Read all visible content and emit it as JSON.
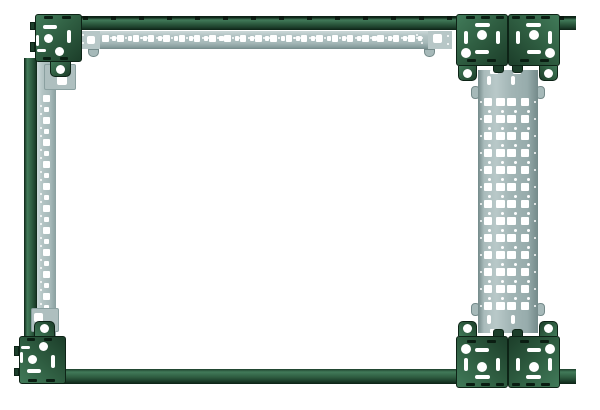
{
  "scene": {
    "background_color": "#ffffff",
    "subject": "Perforated steel rack frame: green corner brackets and frame rails with galvanized perforated mounting strips and one wide perforated mounting rail"
  },
  "palette": {
    "green": "#2e5c40",
    "green_light": "#417a59",
    "green_dark": "#1c3e2a",
    "green_edge": "#0d2316",
    "slot_dark": "#0a1d12",
    "gray": "#a6b9b9",
    "gray_light": "#ccd9d9",
    "gray_dark": "#8aa0a0",
    "gray_edge": "#748a8a",
    "gray_connector": "#b7c7c7",
    "hole_white": "#ffffff"
  },
  "components": {
    "top_rail": "green horizontal frame rail with perforated mounting strip",
    "bottom_rail": "green horizontal frame rail",
    "left_rail": "green vertical frame rail with perforated mounting strip",
    "right_rail": "wide galvanized perforated mounting rail",
    "corner_bracket_top_left": "green corner bracket",
    "corner_bracket_bottom_left": "green corner bracket",
    "corner_bracket_pair_top_right": "paired green corner brackets",
    "corner_bracket_pair_bottom_right": "paired green corner brackets",
    "bracket_count": 6
  },
  "patterns": {
    "top_strip_hole_cells": 21,
    "left_strip_hole_cells": 10,
    "wide_rail_hole_rows": 13,
    "wide_rail_columns_per_row": 4
  }
}
